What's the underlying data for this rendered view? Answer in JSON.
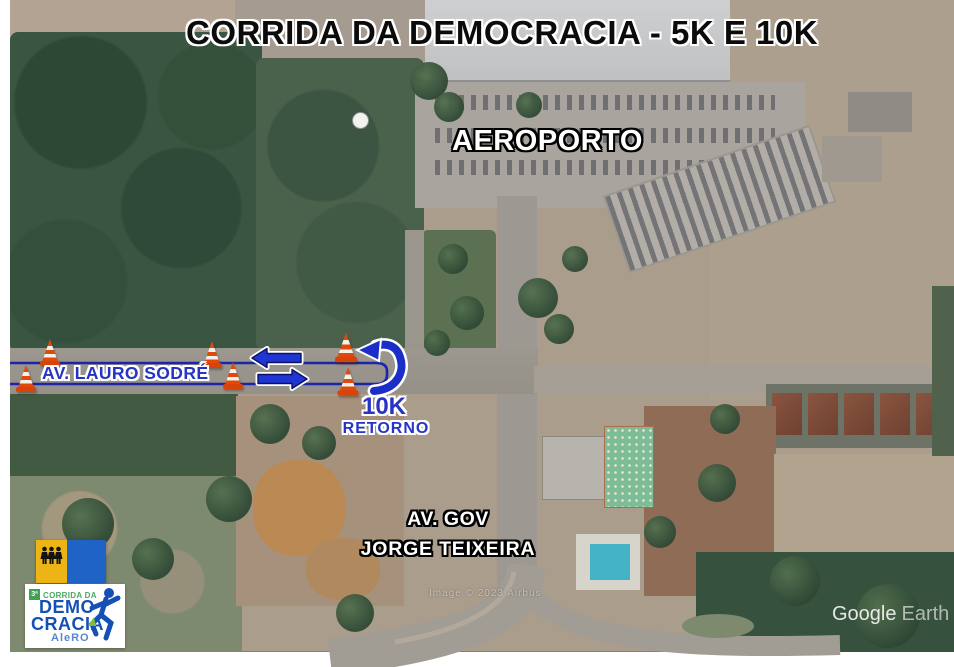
{
  "title": "CORRIDA DA DEMOCRACIA - 5K E 10K",
  "map_labels": {
    "airport": "AEROPORTO",
    "avenue_lauro_sodre": "AV. LAURO SODRÉ",
    "turnaround_distance": "10K",
    "turnaround_word": "RETORNO",
    "avenue_gov_line1": "AV. GOV",
    "avenue_gov_line2": "JORGE TEIXEIRA"
  },
  "route": {
    "color": "#1c2ec8",
    "cone_count": 6
  },
  "watermark": {
    "brand": "Google",
    "product": "Earth",
    "imagery_credit": "Image © 2023 Airbus"
  },
  "logo": {
    "edition_badge": "3ª",
    "top_line": "CORRIDA DA",
    "word_top": "DEMO",
    "word_bottom": "CRACIA",
    "org": "AleRO"
  },
  "colors": {
    "route_blue": "#1c2ec8",
    "arrow_blue": "#1f36d4",
    "label_blue": "#2634c4",
    "cone_orange": "#e0490a",
    "flag_yellow": "#ecb414",
    "flag_blue": "#2063c6",
    "logo_blue": "#1550b4",
    "logo_green": "#3fa254"
  },
  "icons": {
    "traffic_cone": "traffic-cone-icon",
    "arrow_left": "direction-arrow-left-icon",
    "arrow_right": "direction-arrow-right-icon",
    "u_turn": "u-turn-arrow-icon",
    "runner": "runner-icon",
    "flag_people": "flag-emblem-people-icon"
  }
}
